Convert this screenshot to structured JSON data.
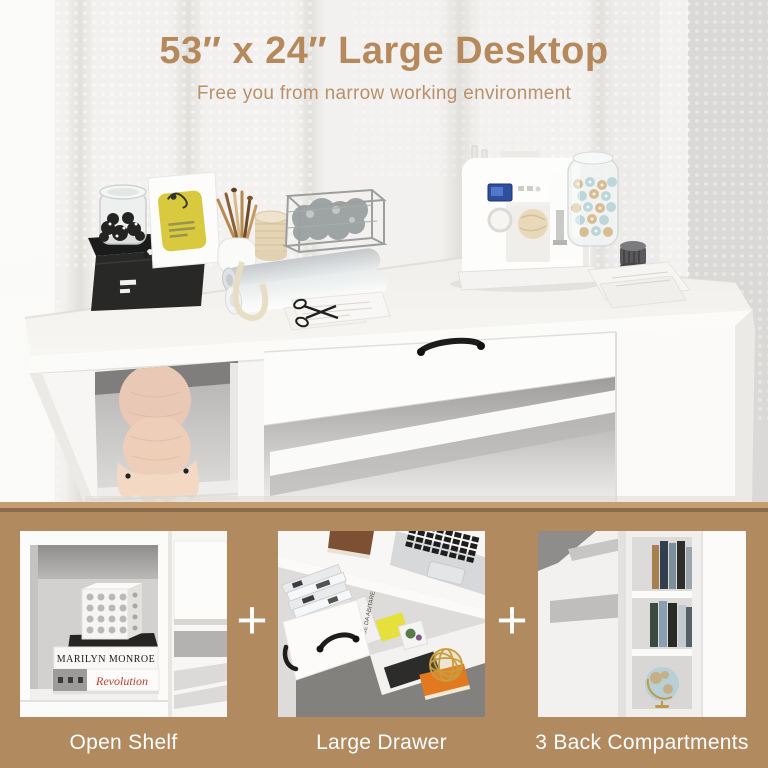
{
  "header": {
    "title": "53″ x 24″ Large Desktop",
    "subtitle": "Free you from narrow working environment"
  },
  "features": {
    "plus": "+",
    "items": [
      {
        "label": "Open Shelf"
      },
      {
        "label": "Large Drawer"
      },
      {
        "label": "3 Back Compartments"
      }
    ]
  },
  "photo_text": {
    "book_top": "MARILYN MONROE",
    "book_bottom": "Revolution",
    "magazine_spine": "CASE DA ABITARE"
  },
  "colors": {
    "accent_tan_text": "#b5895c",
    "band_brown": "#b28a60",
    "label_white": "#ffffff",
    "revolution_red": "#c23b2e",
    "sticky_note_yellow": "#e6e03c",
    "orange_book": "#e2791f",
    "sewing_machine_screen_blue": "#2d4f9e"
  }
}
